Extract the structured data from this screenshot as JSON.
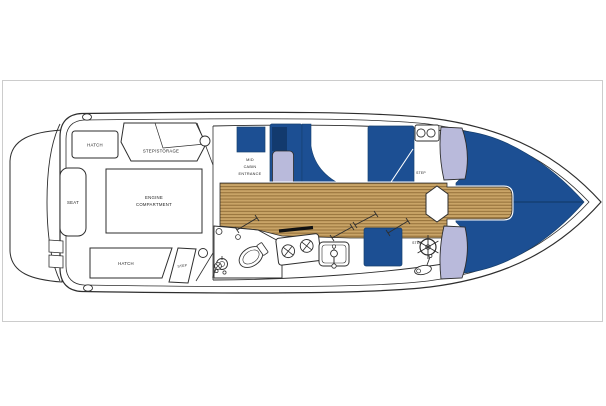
{
  "plan": {
    "title": "boat-deck-plan",
    "labels": {
      "hatch_top": "HATCH",
      "step_storage": "STEP/STORAGE",
      "seat": "SEAT",
      "engine_line1": "ENGINE",
      "engine_line2": "COMPARTMENT",
      "hatch_bottom": "HATCH",
      "step_cockpit": "STEP",
      "mid_line1": "MID",
      "mid_line2": "CABIN",
      "mid_line3": "ENTRANCE",
      "step_bow_top": "STEP",
      "step_bow_bottom": "STEP"
    },
    "colors": {
      "upholstery_blue": "#1c4f93",
      "navy_dark": "#123a6e",
      "seat_lavender": "#b9badb",
      "deck_wood": "#c9a467",
      "plank_line": "#8a6630",
      "outline": "#2e2e2e",
      "frame_border": "#cccccc",
      "bow_seam": "#0f3763"
    }
  }
}
